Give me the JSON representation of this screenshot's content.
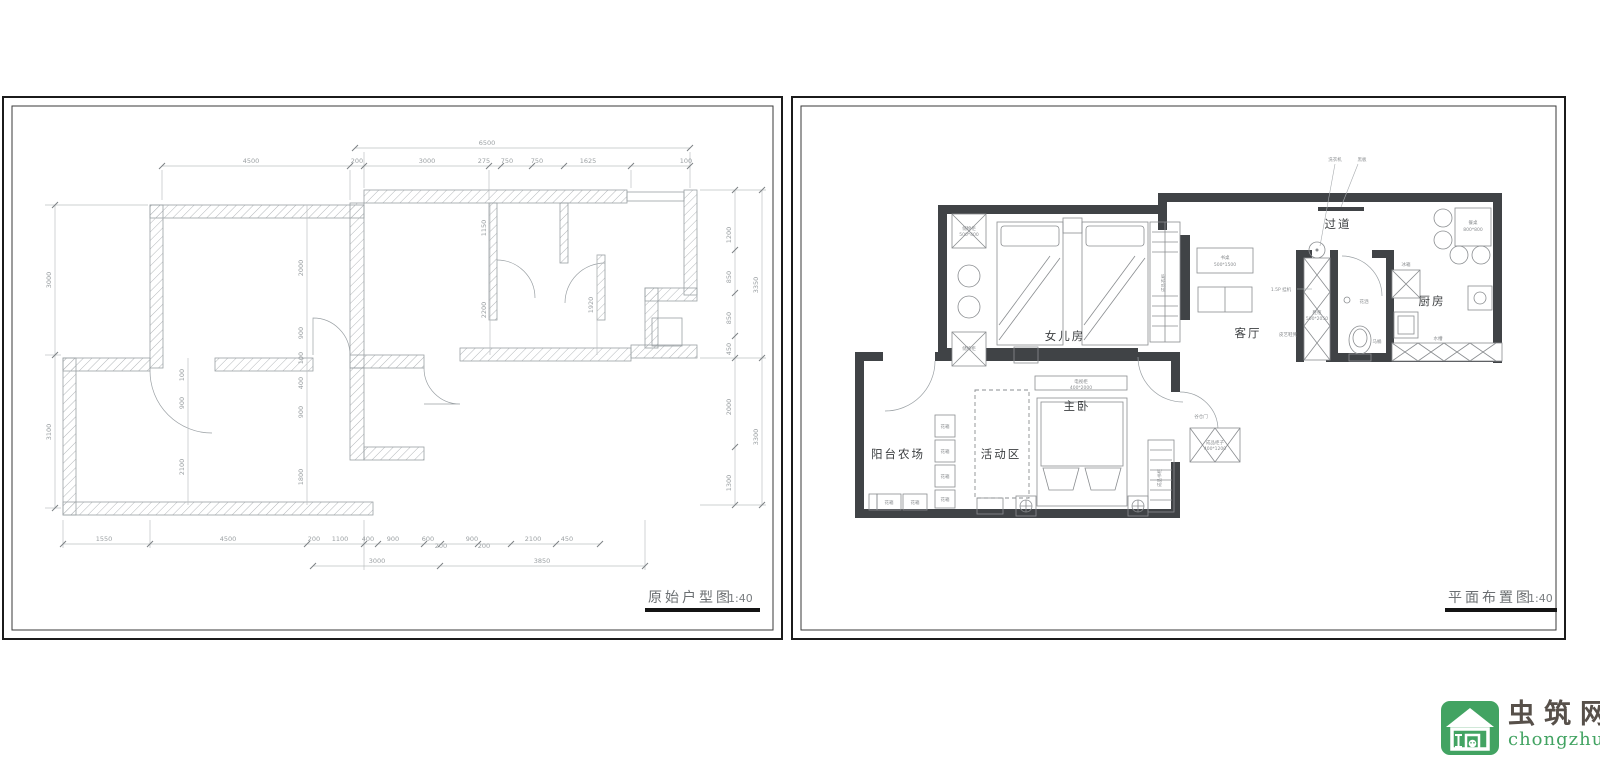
{
  "colors": {
    "brand_green": "#42a362",
    "wall_dark": "#404346",
    "cad_line": "#9aa0a4"
  },
  "left_plan": {
    "title": "原始户型图",
    "scale": "1:40",
    "dims_top": [
      "6500",
      "4500",
      "200",
      "3000",
      "275",
      "750",
      "750",
      "1625",
      "100"
    ],
    "dims_left": [
      "3000",
      "3100"
    ],
    "dims_right": [
      "1200",
      "850",
      "850",
      "450",
      "2000",
      "1300",
      "3350",
      "3300"
    ],
    "dims_bottom": [
      "1550",
      "4500",
      "200",
      "1100",
      "400",
      "900",
      "600",
      "200",
      "900",
      "200",
      "2100",
      "450",
      "3000",
      "3850"
    ],
    "dims_inner": [
      "2000",
      "900",
      "100",
      "400",
      "900",
      "1800",
      "100",
      "900",
      "2100",
      "1150",
      "2200",
      "1920"
    ]
  },
  "right_plan": {
    "title": "平面布置图",
    "scale": "1:40",
    "rooms": {
      "daughter": "女儿房",
      "living": "客厅",
      "corridor": "过道",
      "kitchen": "厨房",
      "master": "主卧",
      "activity": "活动区",
      "balcony": "阳台农场"
    },
    "annotations": {
      "washer": "洗衣机",
      "blackboard": "黑板",
      "dining_table": "餐桌",
      "dining_table_size": "800*800",
      "ac": "1.5P 挂机",
      "shoe_cabinet": "鞋柜",
      "shoe_cabinet_size": "500*2050",
      "shoe_bench": "皮艺鞋凳",
      "toilet": "马桶",
      "shower": "花洒",
      "sink": "水槽",
      "fridge": "冰箱",
      "barn_door": "谷仓门",
      "side_cabinet": "成品柜子",
      "side_cabinet_size": "400*1200",
      "tv_cabinet": "电视柜",
      "tv_cabinet_size": "400*2000",
      "wardrobe": "成品衣柜",
      "storage": "储物柜",
      "storage_size": "500*400",
      "desk": "书桌",
      "desk_size": "500*1500",
      "planter": "花箱",
      "bookshelf": "成品书柜"
    }
  },
  "logo": {
    "site_name": "虫筑网",
    "site_url": "chongzhu.cn"
  }
}
